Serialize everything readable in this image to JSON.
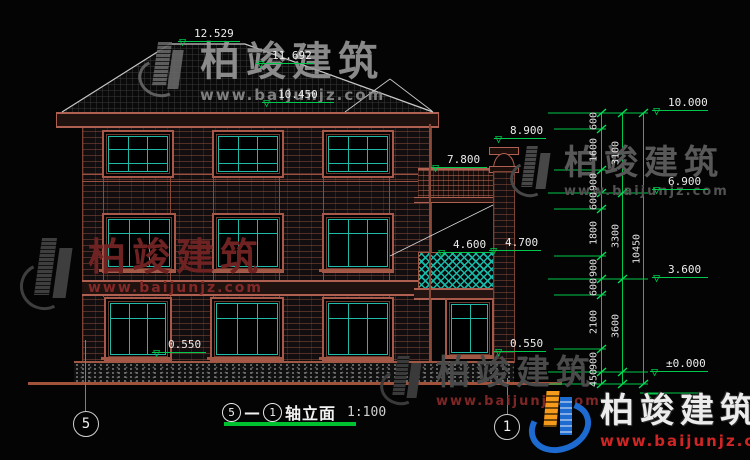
{
  "watermark": {
    "brand": "柏竣建筑",
    "url": "www.baijunjz.com"
  },
  "title": {
    "axis_start": "5",
    "axis_sep": "—",
    "axis_end": "1",
    "label": "轴立面",
    "scale": "1:100"
  },
  "axis_bubbles": {
    "left": "5",
    "right": "1"
  },
  "levels": {
    "roof_peak": "12.529",
    "roof_ridge2": "11.692",
    "roof_eave": "10.450",
    "chimney": "8.900",
    "porch_roof": "7.800",
    "balcony_inner": "4.600",
    "balcony_outer": "4.700",
    "sill_left": "0.550",
    "sill_right": "0.550",
    "right_top": "10.000",
    "right_f3": "6.900",
    "right_f2": "3.600",
    "right_zero": "±0.000"
  },
  "dim_chain": {
    "segments": [
      "600",
      "1600",
      "900",
      "600",
      "1800",
      "900",
      "600",
      "2100",
      "900",
      "450"
    ],
    "subtotals": [
      "3100",
      "3300",
      "3600"
    ],
    "total": "10450"
  },
  "colors": {
    "dim_green": "#00c84a",
    "frame_red": "#b06050",
    "mullion_teal": "#1fb9a8",
    "ground_red": "#a0523a",
    "logo_blue": "#1d6ad0",
    "logo_orange": "#f59a1a",
    "url_red": "#cf2525"
  }
}
